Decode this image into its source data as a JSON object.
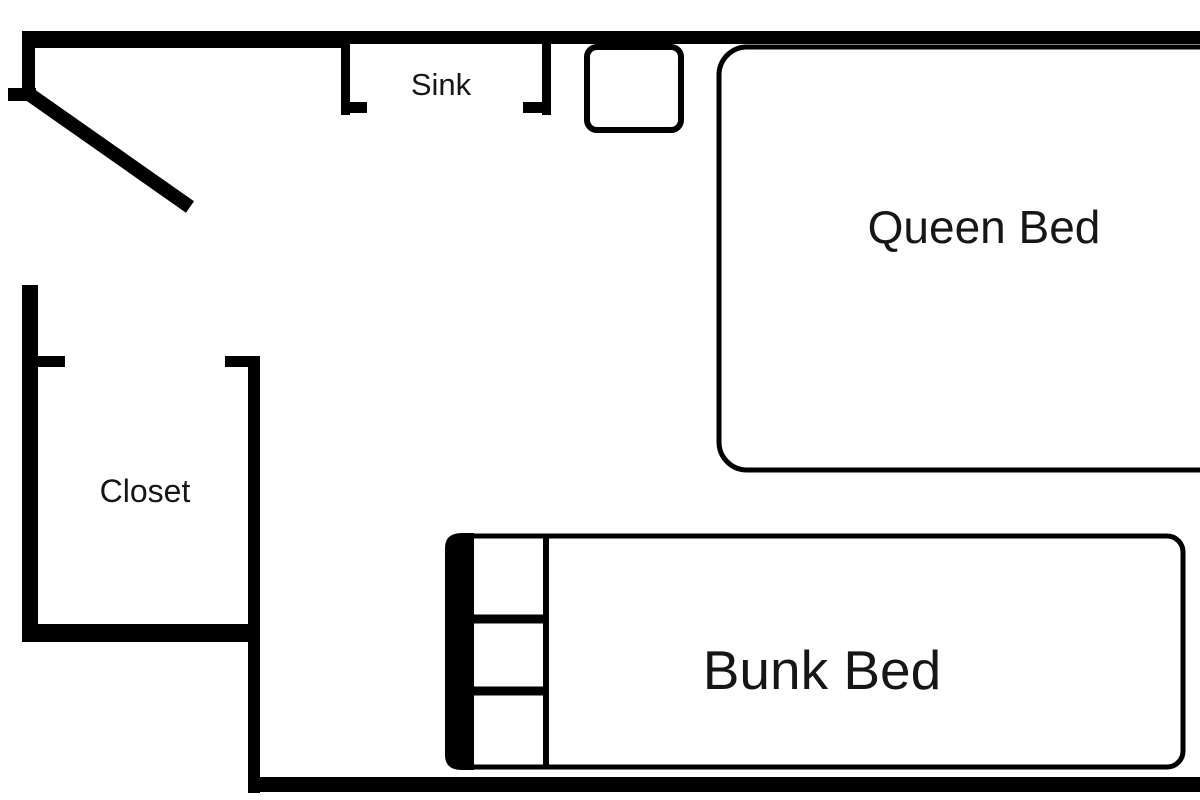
{
  "diagram": {
    "type": "floor-plan",
    "labels": {
      "sink": "Sink",
      "closet": "Closet",
      "queen_bed": "Queen Bed",
      "bunk_bed": "Bunk Bed"
    },
    "colors": {
      "wall": "#000000",
      "furniture_outline": "#000000",
      "text": "#161616",
      "background": "#ffffff"
    }
  }
}
